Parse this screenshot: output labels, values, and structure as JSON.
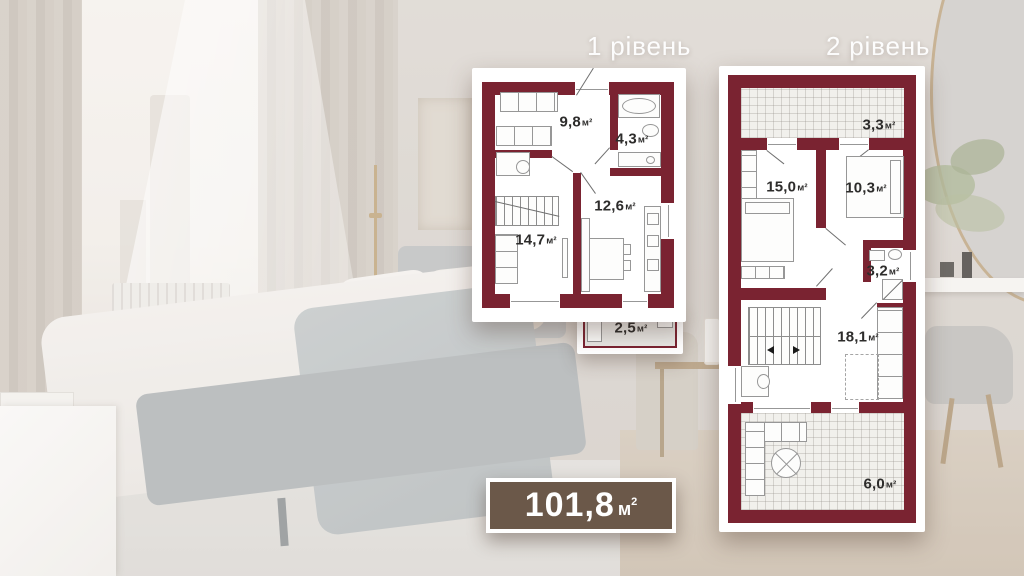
{
  "headers": {
    "level1": "1 рівень",
    "level2": "2 рівень"
  },
  "badge": {
    "value": "101,8",
    "unit": "м",
    "power": "2"
  },
  "colors": {
    "wall": "#7a2331",
    "badge_bg": "#6b5849",
    "floor": "#e9e8e5"
  },
  "plan1": {
    "title": "1 рівень",
    "rooms": [
      {
        "id": "hallway",
        "value": "9,8",
        "unit": "м²"
      },
      {
        "id": "bathroom",
        "value": "4,3",
        "unit": "м²"
      },
      {
        "id": "kitchen",
        "value": "12,6",
        "unit": "м²"
      },
      {
        "id": "living",
        "value": "14,7",
        "unit": "м²"
      },
      {
        "id": "balcony",
        "value": "2,5",
        "unit": "м²"
      }
    ]
  },
  "plan2": {
    "title": "2 рівень",
    "rooms": [
      {
        "id": "terrace-top",
        "value": "3,3",
        "unit": "м²"
      },
      {
        "id": "bedroom-left",
        "value": "15,0",
        "unit": "м²"
      },
      {
        "id": "bedroom-right",
        "value": "10,3",
        "unit": "м²"
      },
      {
        "id": "bathroom",
        "value": "3,2",
        "unit": "м²"
      },
      {
        "id": "hall",
        "value": "18,1",
        "unit": "м²"
      },
      {
        "id": "terrace-bottom",
        "value": "6,0",
        "unit": "м²"
      }
    ]
  }
}
